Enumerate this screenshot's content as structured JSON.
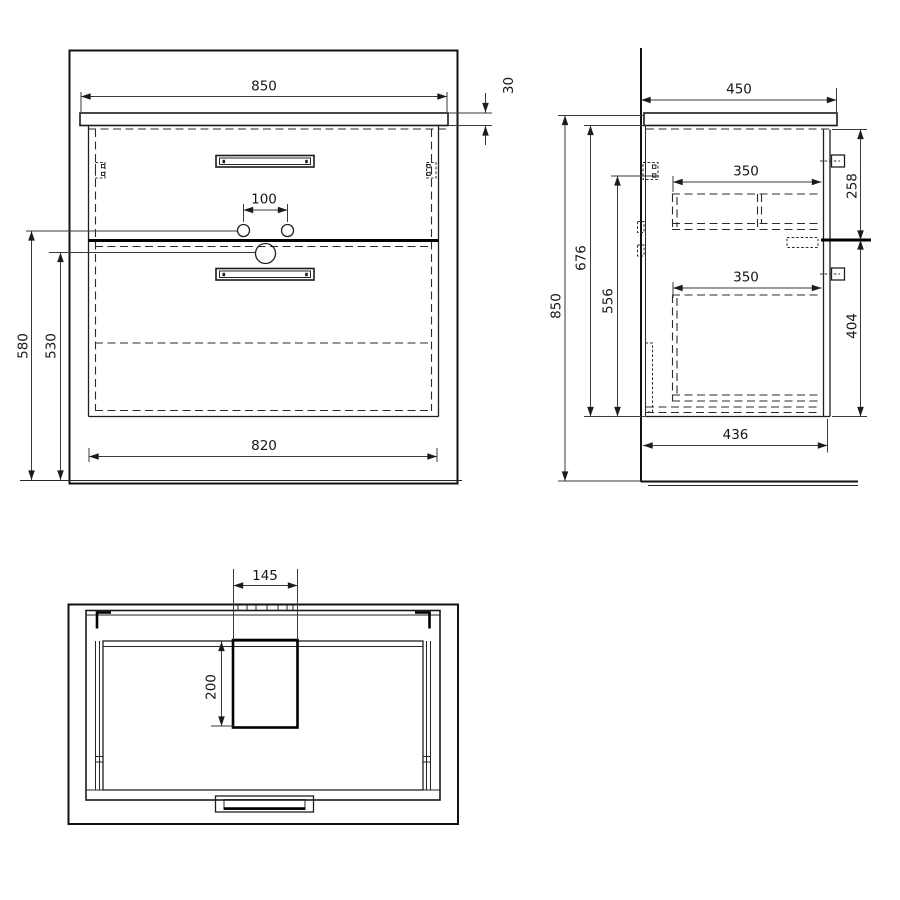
{
  "views": {
    "front": {
      "dimensions": {
        "countertop_width": "850",
        "countertop_thickness": "30",
        "faucet_hole_spacing": "100",
        "supply_height": "580",
        "drain_height": "530",
        "cabinet_width": "820"
      }
    },
    "side": {
      "dimensions": {
        "countertop_depth": "450",
        "total_height": "850",
        "cabinet_height": "676",
        "mount_height": "556",
        "upper_drawer_height": "258",
        "upper_drawer_depth": "350",
        "lower_drawer_depth": "350",
        "lower_drawer_height": "404",
        "cabinet_depth": "436"
      }
    },
    "top": {
      "dimensions": {
        "cutout_width": "145",
        "cutout_depth": "200"
      }
    }
  }
}
